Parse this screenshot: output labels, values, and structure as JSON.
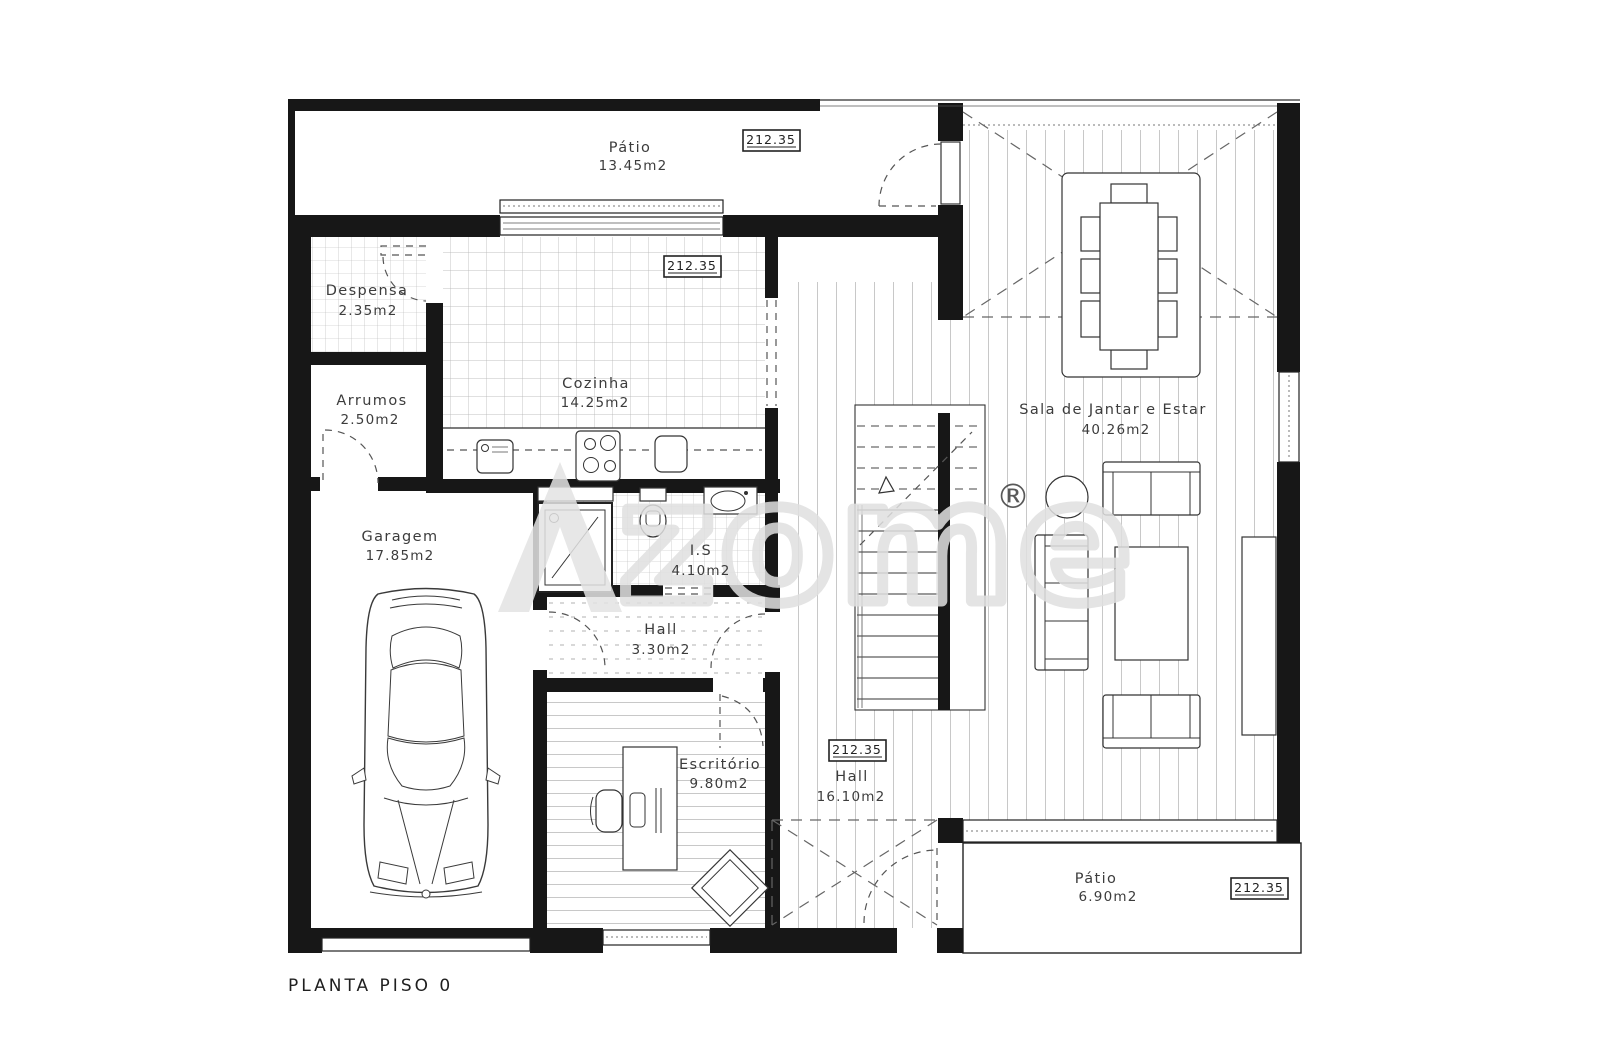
{
  "title": "PLANTA PISO 0",
  "watermark": {
    "text": "zome",
    "reg": "®",
    "color": "#e0e0e0"
  },
  "colors": {
    "wall_ink": "#171717",
    "line_ink": "#3c3c3c",
    "tile_line": "#b3b3b3"
  },
  "elevation_markers": {
    "patio_top": "212.35",
    "cozinha": "212.35",
    "hall_main": "212.35",
    "patio_bottom": "212.35"
  },
  "rooms": {
    "patio_top": {
      "name": "Pátio",
      "area": "13.45m2"
    },
    "despensa": {
      "name": "Despensa",
      "area": "2.35m2"
    },
    "arrumos": {
      "name": "Arrumos",
      "area": "2.50m2"
    },
    "cozinha": {
      "name": "Cozinha",
      "area": "14.25m2"
    },
    "garagem": {
      "name": "Garagem",
      "area": "17.85m2"
    },
    "is": {
      "name": "I.S",
      "area": "4.10m2"
    },
    "hall_small": {
      "name": "Hall",
      "area": "3.30m2"
    },
    "escritorio": {
      "name": "Escritório",
      "area": "9.80m2"
    },
    "hall_main": {
      "name": "Hall",
      "area": "16.10m2"
    },
    "sala": {
      "name": "Sala de Jantar e Estar",
      "area": "40.26m2"
    },
    "patio_bottom": {
      "name": "Pátio",
      "area": "6.90m2"
    }
  }
}
